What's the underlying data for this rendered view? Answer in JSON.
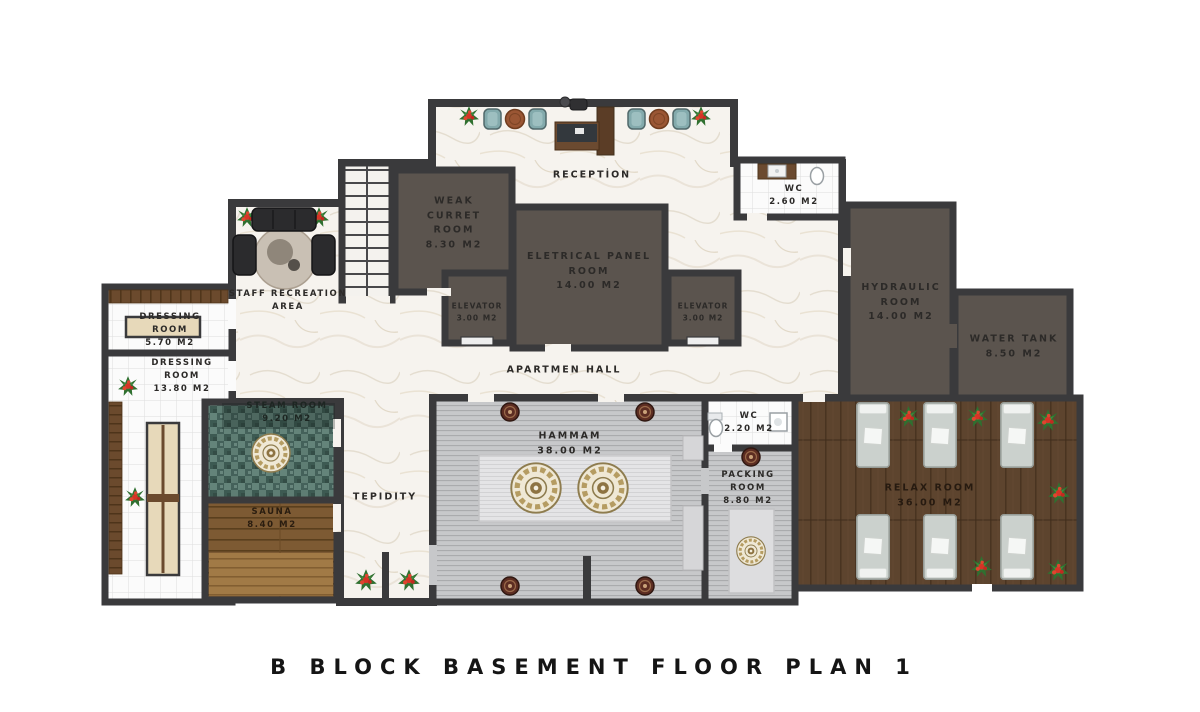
{
  "title": "B  BLOCK  BASEMENT  FLOOR  PLAN  1",
  "rooms": {
    "reception": {
      "lines": [
        "RECEPTİON"
      ]
    },
    "weak_current": {
      "lines": [
        "WEAK",
        "CURRET",
        "ROOM",
        "8.30 M2"
      ]
    },
    "electrical": {
      "lines": [
        "ELETRICAL PANEL",
        "ROOM",
        "14.00 M2"
      ]
    },
    "elevator_left": {
      "lines": [
        "ELEVATOR",
        "3.00 M2"
      ]
    },
    "elevator_right": {
      "lines": [
        "ELEVATOR",
        "3.00 M2"
      ]
    },
    "wc_top": {
      "lines": [
        "WC",
        "2.60 M2"
      ]
    },
    "hydraulic": {
      "lines": [
        "HYDRAULIC",
        "ROOM",
        "14.00 M2"
      ]
    },
    "water_tank": {
      "lines": [
        "WATER TANK",
        "8.50 M2"
      ]
    },
    "staff_recreation": {
      "lines": [
        "STAFF RECREATION",
        "AREA"
      ]
    },
    "dressing_small": {
      "lines": [
        "DRESSING",
        "ROOM",
        "5.70 M2"
      ]
    },
    "dressing_large": {
      "lines": [
        "DRESSING",
        "ROOM",
        "13.80 M2"
      ]
    },
    "steam": {
      "lines": [
        "STEAM ROOM",
        "9.20 M2"
      ]
    },
    "sauna": {
      "lines": [
        "SAUNA",
        "8.40 M2"
      ]
    },
    "tepidity": {
      "lines": [
        "TEPIDITY"
      ]
    },
    "apartment_hall": {
      "lines": [
        "APARTMEN HALL"
      ]
    },
    "hammam": {
      "lines": [
        "HAMMAM",
        "38.00 M2"
      ]
    },
    "wc_mid": {
      "lines": [
        "WC",
        "2.20 M2"
      ]
    },
    "packing": {
      "lines": [
        "PACKING",
        "ROOM",
        "8.80 M2"
      ]
    },
    "relax": {
      "lines": [
        "RELAX ROOM",
        "36.00 M2"
      ]
    }
  },
  "colors": {
    "wall": "#3a3a3c",
    "marble_floor": "#f6f3ee",
    "technical_room": "#5b544e",
    "steam_mosaic": "#4f6f67",
    "sauna_wood": "#7d5a33",
    "relax_wood": "#5d442e",
    "hammam_floor": "#c7c8ca",
    "tile_floor": "#fbfbfb",
    "seat_teal": "#83aaac",
    "flower_red": "#d63426",
    "bench_beige": "#e7d9ba"
  }
}
